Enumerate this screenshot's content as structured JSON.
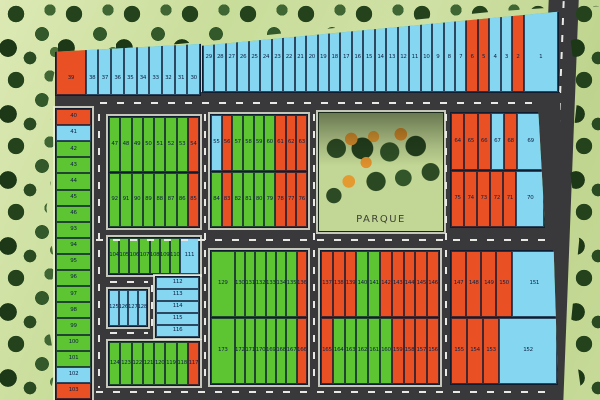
{
  "park": {
    "label": "PARQUE"
  },
  "colors": {
    "lot_blue": "#85d6f0",
    "lot_green": "#5cc531",
    "lot_orange": "#e95125",
    "road": "#39393c",
    "grass": "#cfe0a4",
    "trees": "#24431d"
  },
  "blocks": {
    "strip_a": {
      "lots": [
        {
          "n": "39",
          "c": "orange",
          "w": 2.6
        },
        {
          "n": "38",
          "c": "blue"
        },
        {
          "n": "37",
          "c": "blue"
        },
        {
          "n": "36",
          "c": "blue"
        },
        {
          "n": "35",
          "c": "blue"
        },
        {
          "n": "34",
          "c": "blue"
        },
        {
          "n": "33",
          "c": "blue"
        },
        {
          "n": "32",
          "c": "blue"
        },
        {
          "n": "31",
          "c": "blue"
        },
        {
          "n": "30",
          "c": "blue"
        }
      ]
    },
    "strip_b": {
      "lots": [
        {
          "n": "29",
          "c": "blue"
        },
        {
          "n": "28",
          "c": "blue"
        },
        {
          "n": "27",
          "c": "blue"
        },
        {
          "n": "26",
          "c": "blue"
        },
        {
          "n": "25",
          "c": "blue"
        },
        {
          "n": "24",
          "c": "blue"
        },
        {
          "n": "23",
          "c": "blue"
        },
        {
          "n": "22",
          "c": "blue"
        },
        {
          "n": "21",
          "c": "blue"
        },
        {
          "n": "20",
          "c": "blue"
        },
        {
          "n": "19",
          "c": "blue"
        },
        {
          "n": "18",
          "c": "blue"
        },
        {
          "n": "17",
          "c": "blue"
        },
        {
          "n": "16",
          "c": "blue"
        },
        {
          "n": "15",
          "c": "blue"
        },
        {
          "n": "14",
          "c": "blue"
        },
        {
          "n": "13",
          "c": "blue"
        },
        {
          "n": "12",
          "c": "blue"
        },
        {
          "n": "11",
          "c": "blue"
        },
        {
          "n": "10",
          "c": "blue"
        },
        {
          "n": "9",
          "c": "blue"
        },
        {
          "n": "8",
          "c": "blue"
        },
        {
          "n": "7",
          "c": "blue"
        },
        {
          "n": "6",
          "c": "orange"
        },
        {
          "n": "5",
          "c": "orange"
        },
        {
          "n": "4",
          "c": "blue"
        },
        {
          "n": "3",
          "c": "blue"
        },
        {
          "n": "2",
          "c": "orange"
        },
        {
          "n": "1",
          "c": "blue",
          "w": 3.4
        }
      ]
    },
    "left_col": {
      "lots": [
        {
          "n": "40",
          "c": "orange"
        },
        {
          "n": "41",
          "c": "blue"
        },
        {
          "n": "42",
          "c": "green"
        },
        {
          "n": "43",
          "c": "green"
        },
        {
          "n": "44",
          "c": "green"
        },
        {
          "n": "45",
          "c": "green"
        },
        {
          "n": "46",
          "c": "green"
        },
        {
          "n": "93",
          "c": "green"
        },
        {
          "n": "94",
          "c": "green"
        },
        {
          "n": "95",
          "c": "green"
        },
        {
          "n": "96",
          "c": "green"
        },
        {
          "n": "97",
          "c": "green"
        },
        {
          "n": "98",
          "c": "green"
        },
        {
          "n": "99",
          "c": "green"
        },
        {
          "n": "100",
          "c": "green"
        },
        {
          "n": "101",
          "c": "green"
        },
        {
          "n": "102",
          "c": "blue"
        },
        {
          "n": "103",
          "c": "orange"
        }
      ]
    },
    "b1_top": {
      "lots": [
        {
          "n": "47",
          "c": "green"
        },
        {
          "n": "48",
          "c": "green"
        },
        {
          "n": "49",
          "c": "green"
        },
        {
          "n": "50",
          "c": "green"
        },
        {
          "n": "51",
          "c": "green"
        },
        {
          "n": "52",
          "c": "green"
        },
        {
          "n": "53",
          "c": "green"
        },
        {
          "n": "54",
          "c": "orange"
        }
      ]
    },
    "b1_bot": {
      "lots": [
        {
          "n": "92",
          "c": "green"
        },
        {
          "n": "91",
          "c": "green"
        },
        {
          "n": "90",
          "c": "green"
        },
        {
          "n": "89",
          "c": "green"
        },
        {
          "n": "88",
          "c": "green"
        },
        {
          "n": "87",
          "c": "green"
        },
        {
          "n": "86",
          "c": "green"
        },
        {
          "n": "85",
          "c": "orange"
        }
      ]
    },
    "b2_top": {
      "lots": [
        {
          "n": "55",
          "c": "blue"
        },
        {
          "n": "56",
          "c": "orange"
        },
        {
          "n": "57",
          "c": "green"
        },
        {
          "n": "58",
          "c": "green"
        },
        {
          "n": "59",
          "c": "green"
        },
        {
          "n": "60",
          "c": "green"
        },
        {
          "n": "61",
          "c": "orange"
        },
        {
          "n": "62",
          "c": "orange"
        },
        {
          "n": "63",
          "c": "orange"
        }
      ]
    },
    "b2_bot": {
      "lots": [
        {
          "n": "84",
          "c": "green"
        },
        {
          "n": "83",
          "c": "orange"
        },
        {
          "n": "82",
          "c": "green"
        },
        {
          "n": "81",
          "c": "green"
        },
        {
          "n": "80",
          "c": "green"
        },
        {
          "n": "79",
          "c": "green"
        },
        {
          "n": "78",
          "c": "orange"
        },
        {
          "n": "77",
          "c": "orange"
        },
        {
          "n": "76",
          "c": "orange"
        }
      ]
    },
    "b3_top": {
      "lots": [
        {
          "n": "64",
          "c": "orange"
        },
        {
          "n": "65",
          "c": "orange"
        },
        {
          "n": "66",
          "c": "orange"
        },
        {
          "n": "67",
          "c": "blue"
        },
        {
          "n": "68",
          "c": "orange"
        },
        {
          "n": "69",
          "c": "blue",
          "w": 2.2
        }
      ]
    },
    "b3_bot": {
      "lots": [
        {
          "n": "75",
          "c": "orange"
        },
        {
          "n": "74",
          "c": "orange"
        },
        {
          "n": "73",
          "c": "orange"
        },
        {
          "n": "72",
          "c": "orange"
        },
        {
          "n": "71",
          "c": "orange"
        },
        {
          "n": "70",
          "c": "blue",
          "w": 2.3
        }
      ]
    },
    "q1_row1": {
      "lots": [
        {
          "n": "104",
          "c": "green"
        },
        {
          "n": "105",
          "c": "green"
        },
        {
          "n": "106",
          "c": "green"
        },
        {
          "n": "107",
          "c": "green"
        },
        {
          "n": "108",
          "c": "green"
        },
        {
          "n": "109",
          "c": "green"
        },
        {
          "n": "110",
          "c": "green"
        },
        {
          "n": "111",
          "c": "blue",
          "w": 2.1
        }
      ]
    },
    "q1_stack": {
      "lots": [
        {
          "n": "112",
          "c": "blue"
        },
        {
          "n": "113",
          "c": "blue"
        },
        {
          "n": "114",
          "c": "blue"
        },
        {
          "n": "115",
          "c": "blue"
        },
        {
          "n": "116",
          "c": "blue"
        }
      ]
    },
    "q1_small": {
      "lots": [
        {
          "n": "125",
          "c": "blue"
        },
        {
          "n": "126",
          "c": "blue"
        },
        {
          "n": "127",
          "c": "blue"
        },
        {
          "n": "128",
          "c": "blue"
        }
      ]
    },
    "q1_row2": {
      "lots": [
        {
          "n": "124",
          "c": "green"
        },
        {
          "n": "123",
          "c": "green"
        },
        {
          "n": "122",
          "c": "green"
        },
        {
          "n": "121",
          "c": "green"
        },
        {
          "n": "120",
          "c": "green"
        },
        {
          "n": "119",
          "c": "green"
        },
        {
          "n": "118",
          "c": "green"
        },
        {
          "n": "117",
          "c": "orange"
        }
      ]
    },
    "q2_top": {
      "lots": [
        {
          "n": "129",
          "c": "green",
          "w": 2.6
        },
        {
          "n": "130",
          "c": "green"
        },
        {
          "n": "131",
          "c": "green"
        },
        {
          "n": "132",
          "c": "green"
        },
        {
          "n": "133",
          "c": "green"
        },
        {
          "n": "134",
          "c": "green"
        },
        {
          "n": "135",
          "c": "green"
        },
        {
          "n": "136",
          "c": "orange"
        }
      ]
    },
    "q2_bot": {
      "lots": [
        {
          "n": "173",
          "c": "green",
          "w": 2.6
        },
        {
          "n": "172",
          "c": "green"
        },
        {
          "n": "171",
          "c": "green"
        },
        {
          "n": "170",
          "c": "green"
        },
        {
          "n": "169",
          "c": "green"
        },
        {
          "n": "168",
          "c": "green"
        },
        {
          "n": "167",
          "c": "green"
        },
        {
          "n": "166",
          "c": "orange"
        }
      ]
    },
    "q3_top": {
      "lots": [
        {
          "n": "137",
          "c": "orange"
        },
        {
          "n": "138",
          "c": "orange"
        },
        {
          "n": "139",
          "c": "orange"
        },
        {
          "n": "140",
          "c": "green"
        },
        {
          "n": "141",
          "c": "green"
        },
        {
          "n": "142",
          "c": "orange"
        },
        {
          "n": "143",
          "c": "orange"
        },
        {
          "n": "144",
          "c": "orange"
        },
        {
          "n": "145",
          "c": "orange"
        },
        {
          "n": "146",
          "c": "orange"
        }
      ]
    },
    "q3_bot": {
      "lots": [
        {
          "n": "165",
          "c": "orange"
        },
        {
          "n": "164",
          "c": "green"
        },
        {
          "n": "163",
          "c": "green"
        },
        {
          "n": "162",
          "c": "green"
        },
        {
          "n": "161",
          "c": "green"
        },
        {
          "n": "160",
          "c": "green"
        },
        {
          "n": "159",
          "c": "orange"
        },
        {
          "n": "158",
          "c": "orange"
        },
        {
          "n": "157",
          "c": "orange"
        },
        {
          "n": "156",
          "c": "orange"
        }
      ]
    },
    "q4_top": {
      "lots": [
        {
          "n": "147",
          "c": "orange"
        },
        {
          "n": "148",
          "c": "orange"
        },
        {
          "n": "149",
          "c": "orange"
        },
        {
          "n": "150",
          "c": "orange"
        },
        {
          "n": "151",
          "c": "blue",
          "w": 3.3
        }
      ]
    },
    "q4_bot": {
      "lots": [
        {
          "n": "155",
          "c": "orange"
        },
        {
          "n": "154",
          "c": "orange"
        },
        {
          "n": "153",
          "c": "orange"
        },
        {
          "n": "152",
          "c": "blue",
          "w": 4
        }
      ]
    }
  }
}
